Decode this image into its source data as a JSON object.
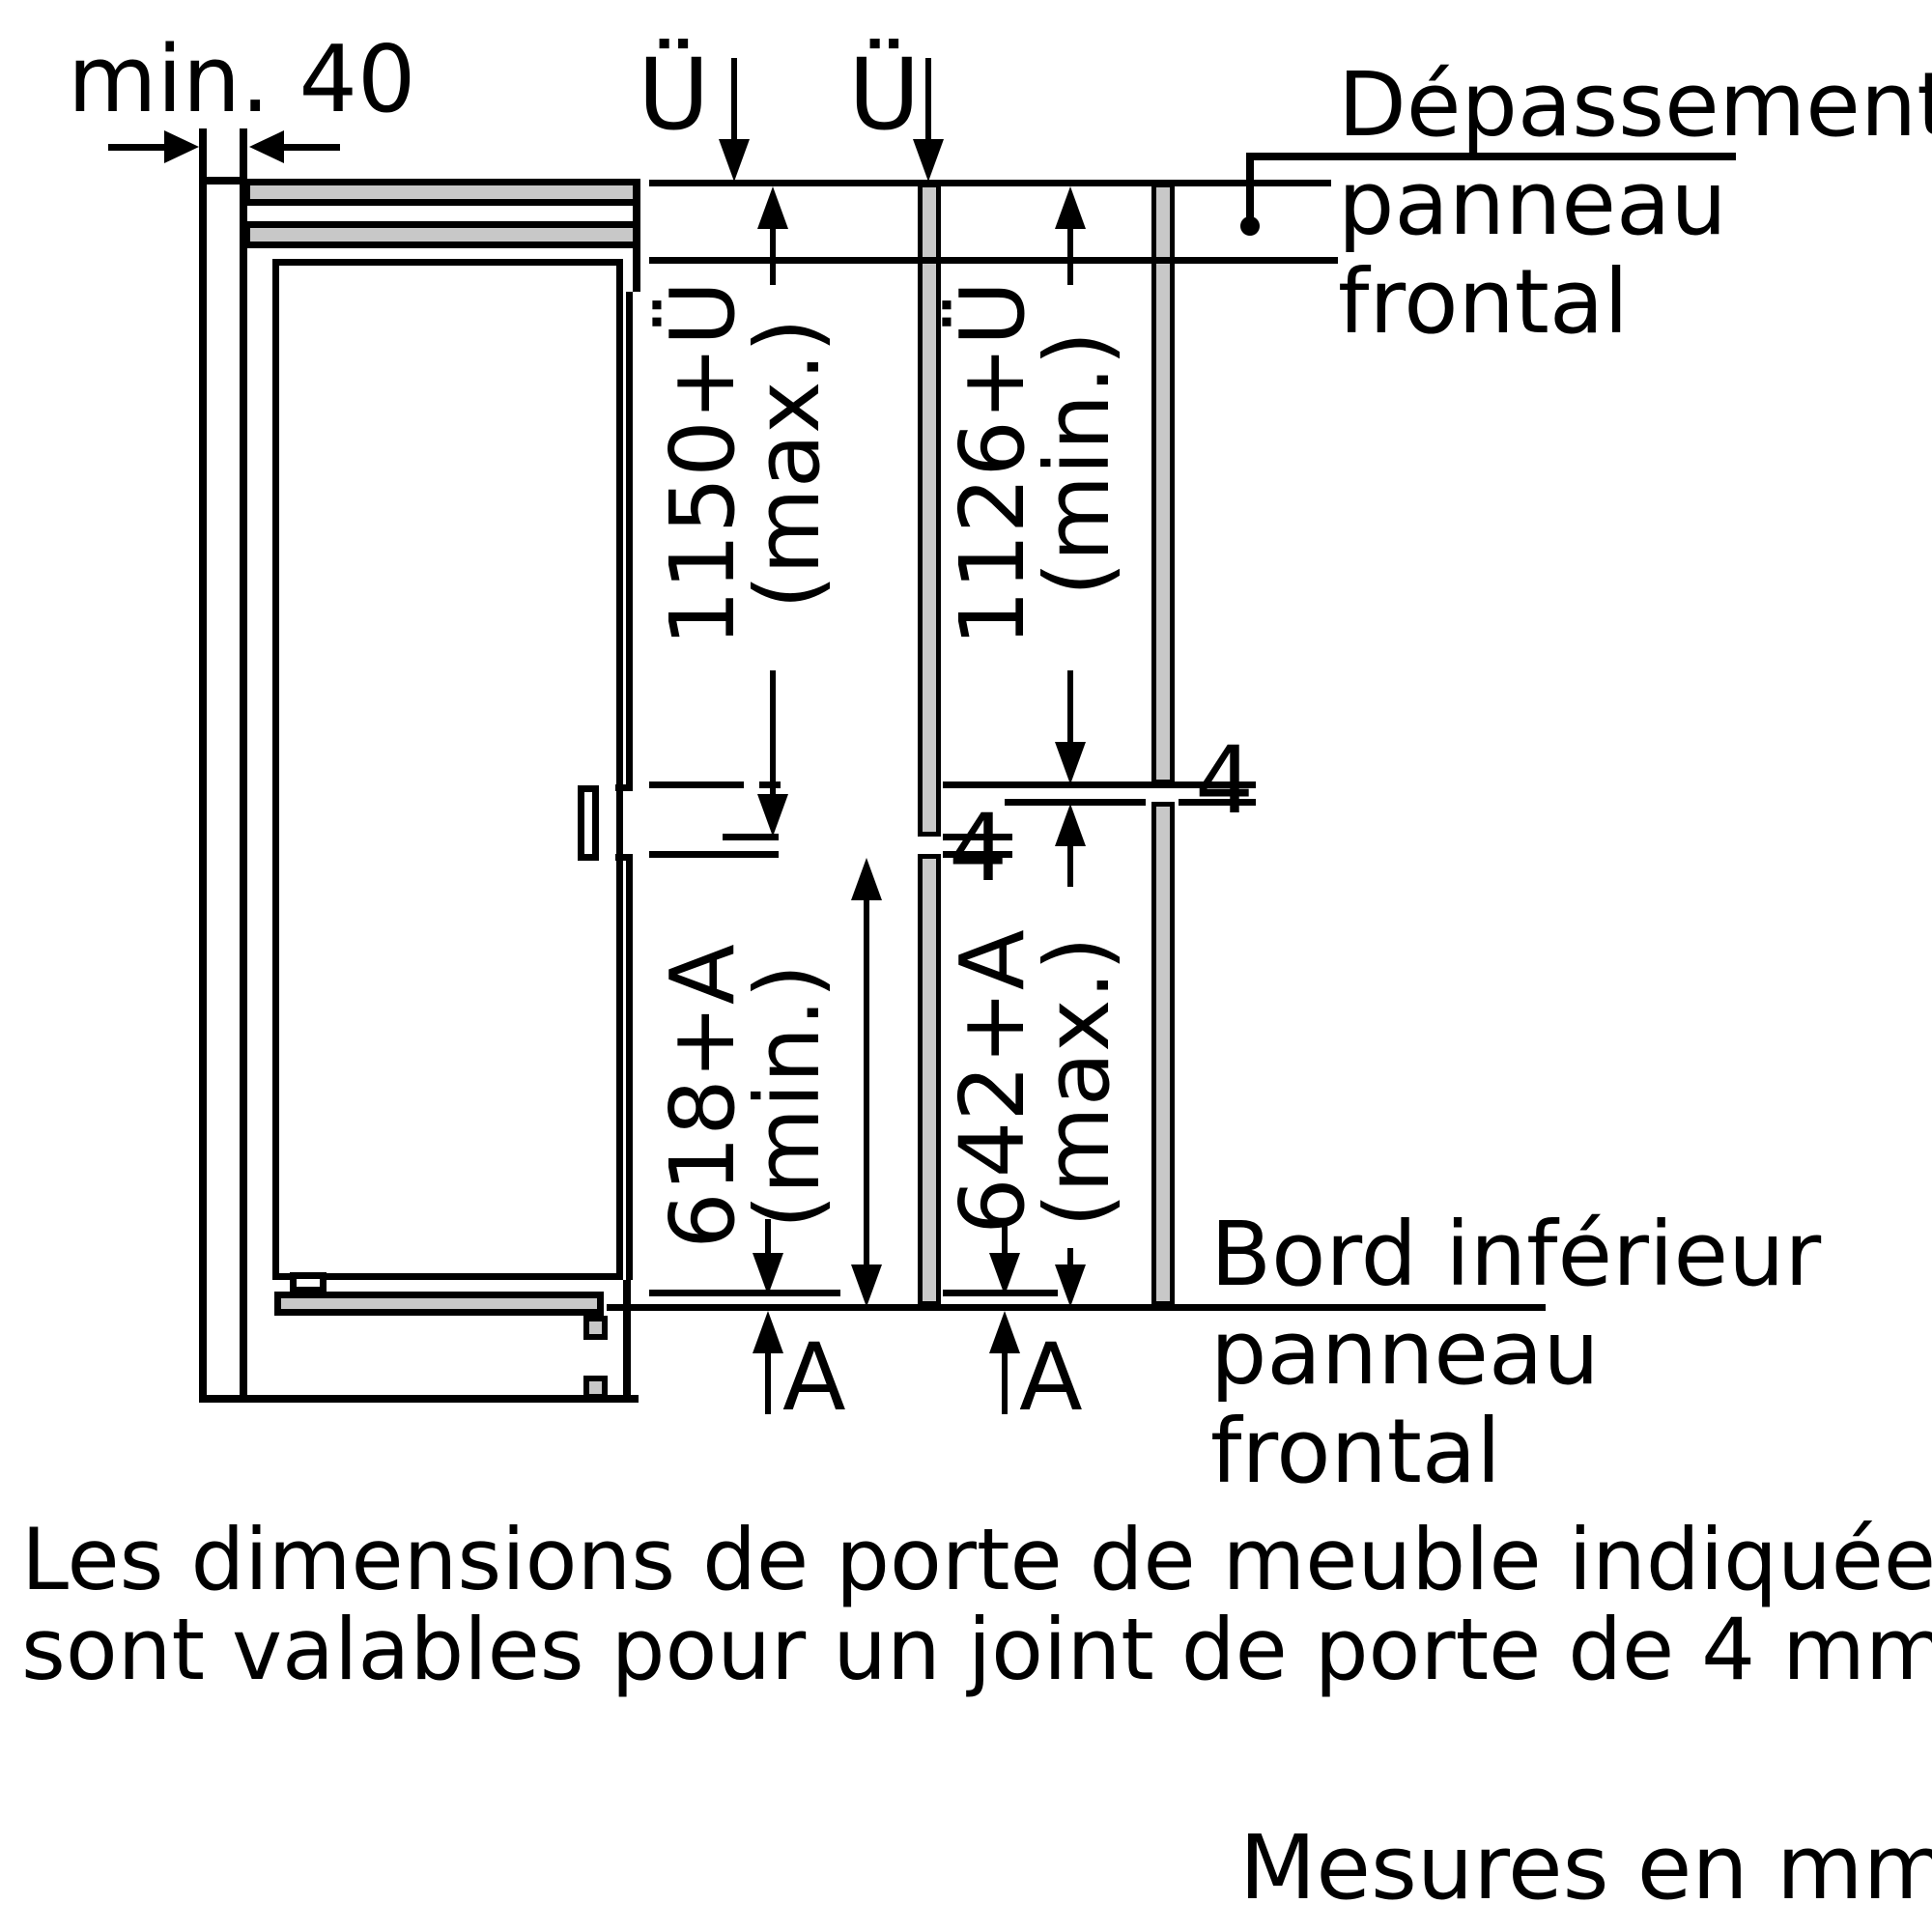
{
  "drawing": {
    "wall_clearance_label": "min. 40",
    "overhang_symbol": "Ü",
    "bottom_gap_symbol": "A",
    "panel_joint_gap": "4",
    "scenarios": {
      "left": {
        "upper_value": "1150+Ü",
        "upper_qual": "(max.)",
        "lower_value": "618+A",
        "lower_qual": "(min.)"
      },
      "right": {
        "upper_value": "1126+Ü",
        "upper_qual": "(min.)",
        "lower_value": "642+A",
        "lower_qual": "(max.)"
      }
    },
    "callout_top": {
      "line1": "Dépassement",
      "line2": "panneau",
      "line3": "frontal"
    },
    "callout_bottom": {
      "line1": "Bord inférieur",
      "line2": "panneau",
      "line3": "frontal"
    },
    "colors": {
      "ink": "#000000",
      "panel_fill": "#c8c8c8",
      "background": "#ffffff"
    }
  },
  "note": {
    "line1": "Les dimensions de porte de meuble indiquées",
    "line2": "sont valables pour un joint de porte de 4 mm"
  },
  "units_label": "Mesures en mm"
}
